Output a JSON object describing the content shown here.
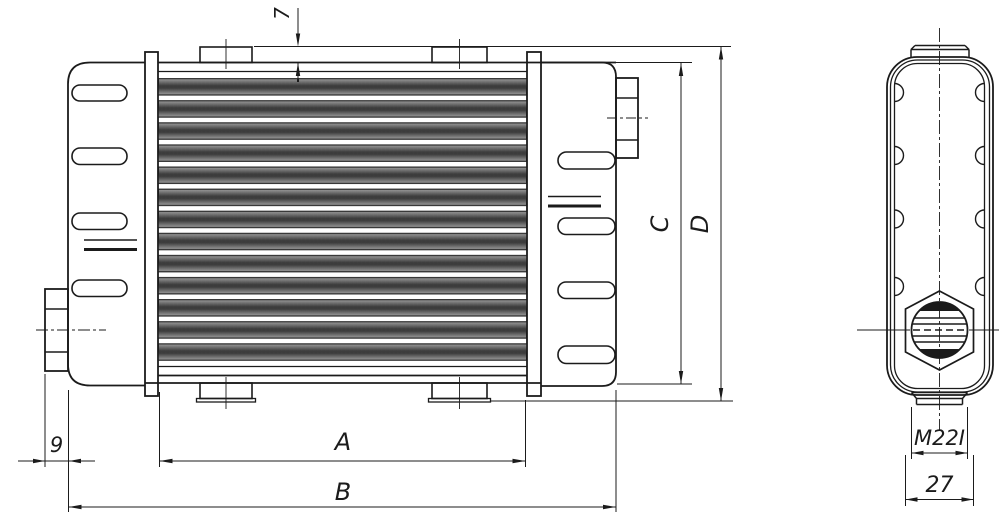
{
  "drawing": {
    "type": "technical-drawing-oil-cooler",
    "background_color": "#ffffff",
    "line_color": "#1b1b1b",
    "dimensions": {
      "boss_height": "7",
      "fitting_protrusion": "9",
      "core_width": "A",
      "overall_width": "B",
      "tank_height": "C",
      "overall_height": "D",
      "thread_label": "M22I",
      "end_view_width": "27"
    }
  }
}
